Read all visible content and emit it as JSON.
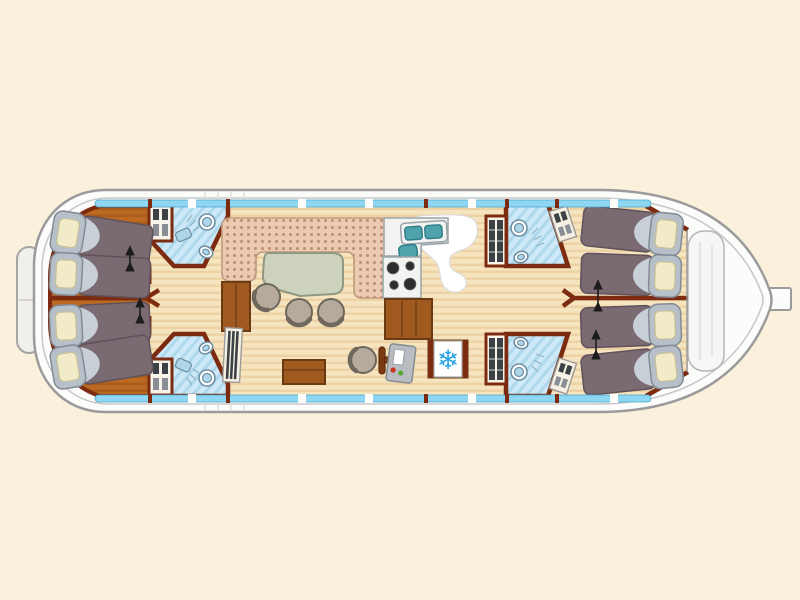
{
  "title": "penichette-boat-floor-plan",
  "layout_hint": {
    "bow": "left",
    "stern": "right",
    "orientation": "horizontal"
  },
  "icons": {
    "snowflake": "❄"
  },
  "counts": {
    "beds": 8,
    "cabins": 4,
    "bathrooms": 4,
    "wardrobes": 4
  },
  "rooms": [
    {
      "name": "bow-cabin-port",
      "furniture": [
        "single-bed",
        "single-bed",
        "slide-arrow"
      ]
    },
    {
      "name": "bow-cabin-starboard",
      "furniture": [
        "single-bed",
        "single-bed",
        "slide-arrow"
      ]
    },
    {
      "name": "forward-bathroom-port",
      "furniture": [
        "shower",
        "toilet",
        "washbasin"
      ]
    },
    {
      "name": "forward-bathroom-starboard",
      "furniture": [
        "shower",
        "toilet",
        "washbasin"
      ]
    },
    {
      "name": "salon",
      "furniture": [
        "u-shaped-bench",
        "table",
        "stool",
        "stool",
        "stool",
        "storage-chest"
      ]
    },
    {
      "name": "galley",
      "furniture": [
        "double-sink",
        "stove",
        "cabinet",
        "fridge-freezer"
      ]
    },
    {
      "name": "helm-station",
      "furniture": [
        "helm-chair",
        "steering-wheel",
        "control-panel"
      ]
    },
    {
      "name": "aft-bathroom-port",
      "furniture": [
        "shower",
        "toilet",
        "washbasin"
      ]
    },
    {
      "name": "aft-bathroom-starboard",
      "furniture": [
        "shower",
        "toilet",
        "washbasin"
      ]
    },
    {
      "name": "stern-cabin-port",
      "furniture": [
        "single-bed",
        "single-bed",
        "slide-arrow"
      ]
    },
    {
      "name": "stern-cabin-starboard",
      "furniture": [
        "single-bed",
        "single-bed",
        "slide-arrow"
      ]
    },
    {
      "name": "stern-deck",
      "furniture": []
    }
  ],
  "palette": {
    "background": "#faf0dc",
    "hull_fill": "#fcfcfb",
    "hull_stroke": "#9b9b9b",
    "inner_line": "#c9c9c9",
    "stern_deck": "#f6f6f4",
    "window_blue": "#8fd6f2",
    "window_stroke": "#49a8cc",
    "wall": "#7c2b10",
    "wood_light": "#f6e4bf",
    "wood_dark": "#ecd2a4",
    "bow_light": "#bc6a22",
    "bow_dark": "#aa5c1a",
    "mattress": "#7a6a72",
    "mattress_stroke": "#60525a",
    "blanket": "#c9cfd6",
    "pillow_frame": "#b7bfc8",
    "pillow_frame_stroke": "#828c96",
    "pillow": "#f2ebc8",
    "pillow_stroke": "#c8c09a",
    "bath_fill": "#cde8f6",
    "bath_stripe": "#aed8ec",
    "fixture_fill": "#ffffff",
    "fixture_stroke": "#6f8fa3",
    "fixture_blue": "#aed6ea",
    "bench_fill": "#eccab2",
    "bench_dot": "#bc8f72",
    "bench_stroke": "#c09a7e",
    "table_fill": "#cdd2bd",
    "table_stroke": "#8f9880",
    "chair_fill": "#b5aa9b",
    "chair_stroke": "#6e675c",
    "wood_mid": "#a05a20",
    "wood_mid_stroke": "#6b3a12",
    "sink_teal": "#4fa3ad",
    "sink_teal_stroke": "#2f7f8a",
    "counter": "#f2f2f0",
    "counter_stroke": "#9aa4a8",
    "burner": "#2d2d2d",
    "panel": "#b9bdc2",
    "panel_stroke": "#878c91",
    "red": "#cc3322",
    "green": "#55aa33",
    "snowflake": "#2aa4e6",
    "arrow": "#1c1c1c",
    "slat": "#3c4146"
  }
}
